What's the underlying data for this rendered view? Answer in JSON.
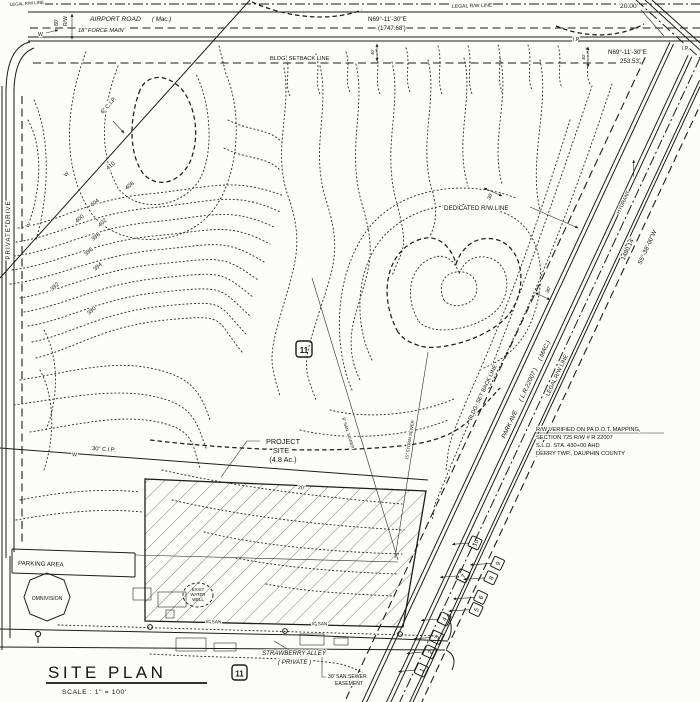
{
  "drawing": {
    "title_block": {
      "title": "SITE PLAN",
      "scale": "SCALE : 1\" = 100'"
    },
    "airport_road": {
      "name": "AIRPORT ROAD",
      "surface_note": "( Mac.)",
      "force_main": "18\" FORCE MAIN",
      "legal_rw_line": "LEGAL R/W LINE",
      "legal_rw_corner": "LEGAL R/W LINE",
      "rw_width": "80'",
      "rw_abbrev": "R/W",
      "bearing1": "N69°-11'-30\"E",
      "distance1": "(1747.68')",
      "offset": "20.00'",
      "bearing2": "N69°-11'-30\"E",
      "distance2": "253.53'",
      "setback_line": "BLDG. SETBACK LINE",
      "dim_a": "40'",
      "dim_b": "40'",
      "water_marker": "W",
      "ip1": "I.P",
      "ip2": "I.P."
    },
    "park_ave": {
      "name": "PARK AVE.",
      "route_note": "( L.R.22007 )",
      "surface_note": "( MAC.)",
      "setback_line": "BLDG. SET BACK LINE",
      "legal_rw_line": "LEGAL R/W LINE",
      "dedicated_rw_line": "DEDICATED R/W LINE",
      "bearing": "S5°-38'-00\"W",
      "distance": "1480.14'",
      "hydrant": "HYDRANT",
      "setback_dim": "30'",
      "dim_b": "30'",
      "lot_markers": [
        "1",
        "2",
        "3",
        "4",
        "5",
        "6",
        "7",
        "8",
        "9",
        "10"
      ]
    },
    "private_drive": {
      "name": "PRIVATE DRIVE"
    },
    "strawberry_alley": {
      "name": "STRAWBERRY ALLEY",
      "note": "( PRIVATE )",
      "sewer_a": "8\" SAN",
      "sewer_b": "8\" SAN",
      "easement_l1": "30' SAN.SEWER",
      "easement_l2": "EASEMENT"
    },
    "site": {
      "l1": "PROJECT",
      "l2": "SITE",
      "l3": "(4.8 Ac.)",
      "parcel_marker": "11",
      "parcel_marker2": "11"
    },
    "features": {
      "parking": "PARKING AREA",
      "building": "OMNIVISION",
      "well_l1": "EXIST",
      "well_l2": "WATER",
      "well_l3": "WELL",
      "pipe6": "6\" C.I.P.",
      "pipe30": "30\" C.I.P.",
      "storm": "15\" STORM SEWER",
      "san_lateral": "8\" SAN. SEWER",
      "dim20": "20'",
      "w1": "W",
      "w2": "W",
      "w3": "W"
    },
    "rw_note": {
      "l1": "R/W VERIFIED ON PA D.O.T. MAPPING,",
      "l2": "SECTION 725 R/W # R 22007",
      "l3": "S.L.D. STA. 430+00 AHD",
      "l4": "DERRY TWP., DAUPHIN COUNTY"
    },
    "contour_labels": [
      "410",
      "408",
      "404",
      "402",
      "400",
      "398",
      "396",
      "394",
      "392",
      "390"
    ]
  }
}
